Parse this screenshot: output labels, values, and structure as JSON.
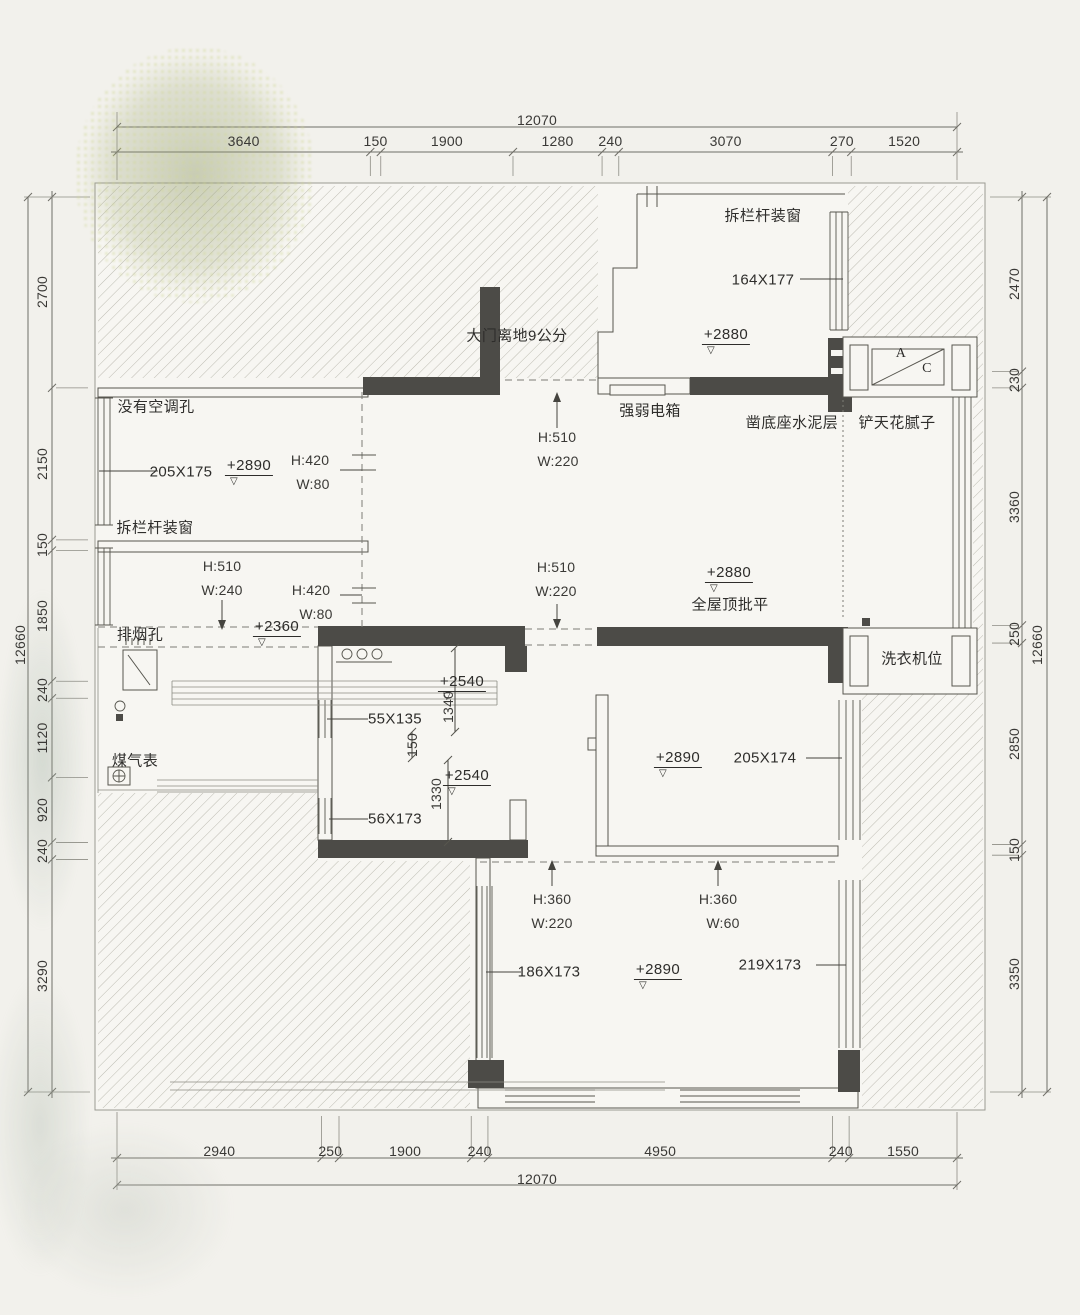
{
  "title": "renovation-floor-plan",
  "colors": {
    "paper": "#f2f1ec",
    "room": "#f7f6f2",
    "wall_dark": "#4c4b47",
    "line": "#57564f",
    "hatch_line": "#bdbcb2",
    "text": "#2e2d2b"
  },
  "dimensions": {
    "top": {
      "overall": "12070",
      "segments": [
        "3640",
        "150",
        "1900",
        "1280",
        "240",
        "3070",
        "270",
        "1520"
      ]
    },
    "bottom": {
      "overall": "12070",
      "segments": [
        "2940",
        "250",
        "1900",
        "240",
        "4950",
        "240",
        "1550"
      ]
    },
    "left": {
      "overall": "12660",
      "segments": [
        "2700",
        "2150",
        "150",
        "1850",
        "240",
        "1120",
        "920",
        "240",
        "3290"
      ]
    },
    "right": {
      "overall": "12660",
      "segments": [
        "2470",
        "230",
        "3360",
        "250",
        "2850",
        "150",
        "3350"
      ]
    }
  },
  "annotations": [
    {
      "text": "拆栏杆装窗",
      "x": 763,
      "y": 216
    },
    {
      "text": "164X177",
      "x": 763,
      "y": 280
    },
    {
      "text": "+2880",
      "x": 726,
      "y": 336,
      "cls": "lvl"
    },
    {
      "text": "▽",
      "x": 711,
      "y": 351,
      "cls": "tri"
    },
    {
      "text": "大门离地9公分",
      "x": 517,
      "y": 336
    },
    {
      "text": "强弱电箱",
      "x": 650,
      "y": 411
    },
    {
      "text": "凿底座水泥层",
      "x": 792,
      "y": 423
    },
    {
      "text": "铲天花腻子",
      "x": 897,
      "y": 423
    },
    {
      "text": "A",
      "x": 901,
      "y": 354,
      "cls": "ac"
    },
    {
      "text": "C",
      "x": 927,
      "y": 369,
      "cls": "ac"
    },
    {
      "text": "没有空调孔",
      "x": 156,
      "y": 407
    },
    {
      "text": "205X175",
      "x": 181,
      "y": 472
    },
    {
      "text": "+2890",
      "x": 249,
      "y": 467,
      "cls": "lvl"
    },
    {
      "text": "▽",
      "x": 234,
      "y": 482,
      "cls": "tri"
    },
    {
      "text": "H:420",
      "x": 310,
      "y": 460,
      "cls": "dm"
    },
    {
      "text": "W:80",
      "x": 313,
      "y": 484,
      "cls": "dm"
    },
    {
      "text": "拆栏杆装窗",
      "x": 155,
      "y": 528
    },
    {
      "text": "H:510",
      "x": 222,
      "y": 566,
      "cls": "dm"
    },
    {
      "text": "W:240",
      "x": 222,
      "y": 590,
      "cls": "dm"
    },
    {
      "text": "H:420",
      "x": 311,
      "y": 590,
      "cls": "dm"
    },
    {
      "text": "W:80",
      "x": 316,
      "y": 614,
      "cls": "dm"
    },
    {
      "text": "H:510",
      "x": 557,
      "y": 437,
      "cls": "dm"
    },
    {
      "text": "W:220",
      "x": 558,
      "y": 461,
      "cls": "dm"
    },
    {
      "text": "H:510",
      "x": 556,
      "y": 567,
      "cls": "dm"
    },
    {
      "text": "W:220",
      "x": 556,
      "y": 591,
      "cls": "dm"
    },
    {
      "text": "+2880",
      "x": 729,
      "y": 574,
      "cls": "lvl"
    },
    {
      "text": "▽",
      "x": 714,
      "y": 589,
      "cls": "tri"
    },
    {
      "text": "全屋顶批平",
      "x": 730,
      "y": 605
    },
    {
      "text": "排烟孔",
      "x": 140,
      "y": 635
    },
    {
      "text": "+2360",
      "x": 277,
      "y": 628,
      "cls": "lvl"
    },
    {
      "text": "▽",
      "x": 262,
      "y": 643,
      "cls": "tri"
    },
    {
      "text": "55X135",
      "x": 395,
      "y": 719
    },
    {
      "text": "+2540",
      "x": 462,
      "y": 683,
      "cls": "lvl"
    },
    {
      "text": "▽",
      "x": 447,
      "y": 697,
      "cls": "tri"
    },
    {
      "text": "1340",
      "x": 448,
      "y": 707,
      "rot": -90,
      "cls": "dm"
    },
    {
      "text": "150",
      "x": 412,
      "y": 745,
      "rot": -90,
      "cls": "dm"
    },
    {
      "text": "1330",
      "x": 436,
      "y": 794,
      "rot": -90,
      "cls": "dm"
    },
    {
      "text": "+2540",
      "x": 467,
      "y": 777,
      "cls": "lvl"
    },
    {
      "text": "▽",
      "x": 452,
      "y": 792,
      "cls": "tri"
    },
    {
      "text": "56X173",
      "x": 395,
      "y": 819
    },
    {
      "text": "煤气表",
      "x": 135,
      "y": 761
    },
    {
      "text": "洗衣机位",
      "x": 912,
      "y": 659
    },
    {
      "text": "+2890",
      "x": 678,
      "y": 759,
      "cls": "lvl"
    },
    {
      "text": "▽",
      "x": 663,
      "y": 774,
      "cls": "tri"
    },
    {
      "text": "205X174",
      "x": 765,
      "y": 758
    },
    {
      "text": "H:360",
      "x": 552,
      "y": 899,
      "cls": "dm"
    },
    {
      "text": "W:220",
      "x": 552,
      "y": 923,
      "cls": "dm"
    },
    {
      "text": "H:360",
      "x": 718,
      "y": 899,
      "cls": "dm"
    },
    {
      "text": "W:60",
      "x": 723,
      "y": 923,
      "cls": "dm"
    },
    {
      "text": "186X173",
      "x": 549,
      "y": 972
    },
    {
      "text": "+2890",
      "x": 658,
      "y": 971,
      "cls": "lvl"
    },
    {
      "text": "▽",
      "x": 643,
      "y": 986,
      "cls": "tri"
    },
    {
      "text": "219X173",
      "x": 770,
      "y": 965
    }
  ]
}
